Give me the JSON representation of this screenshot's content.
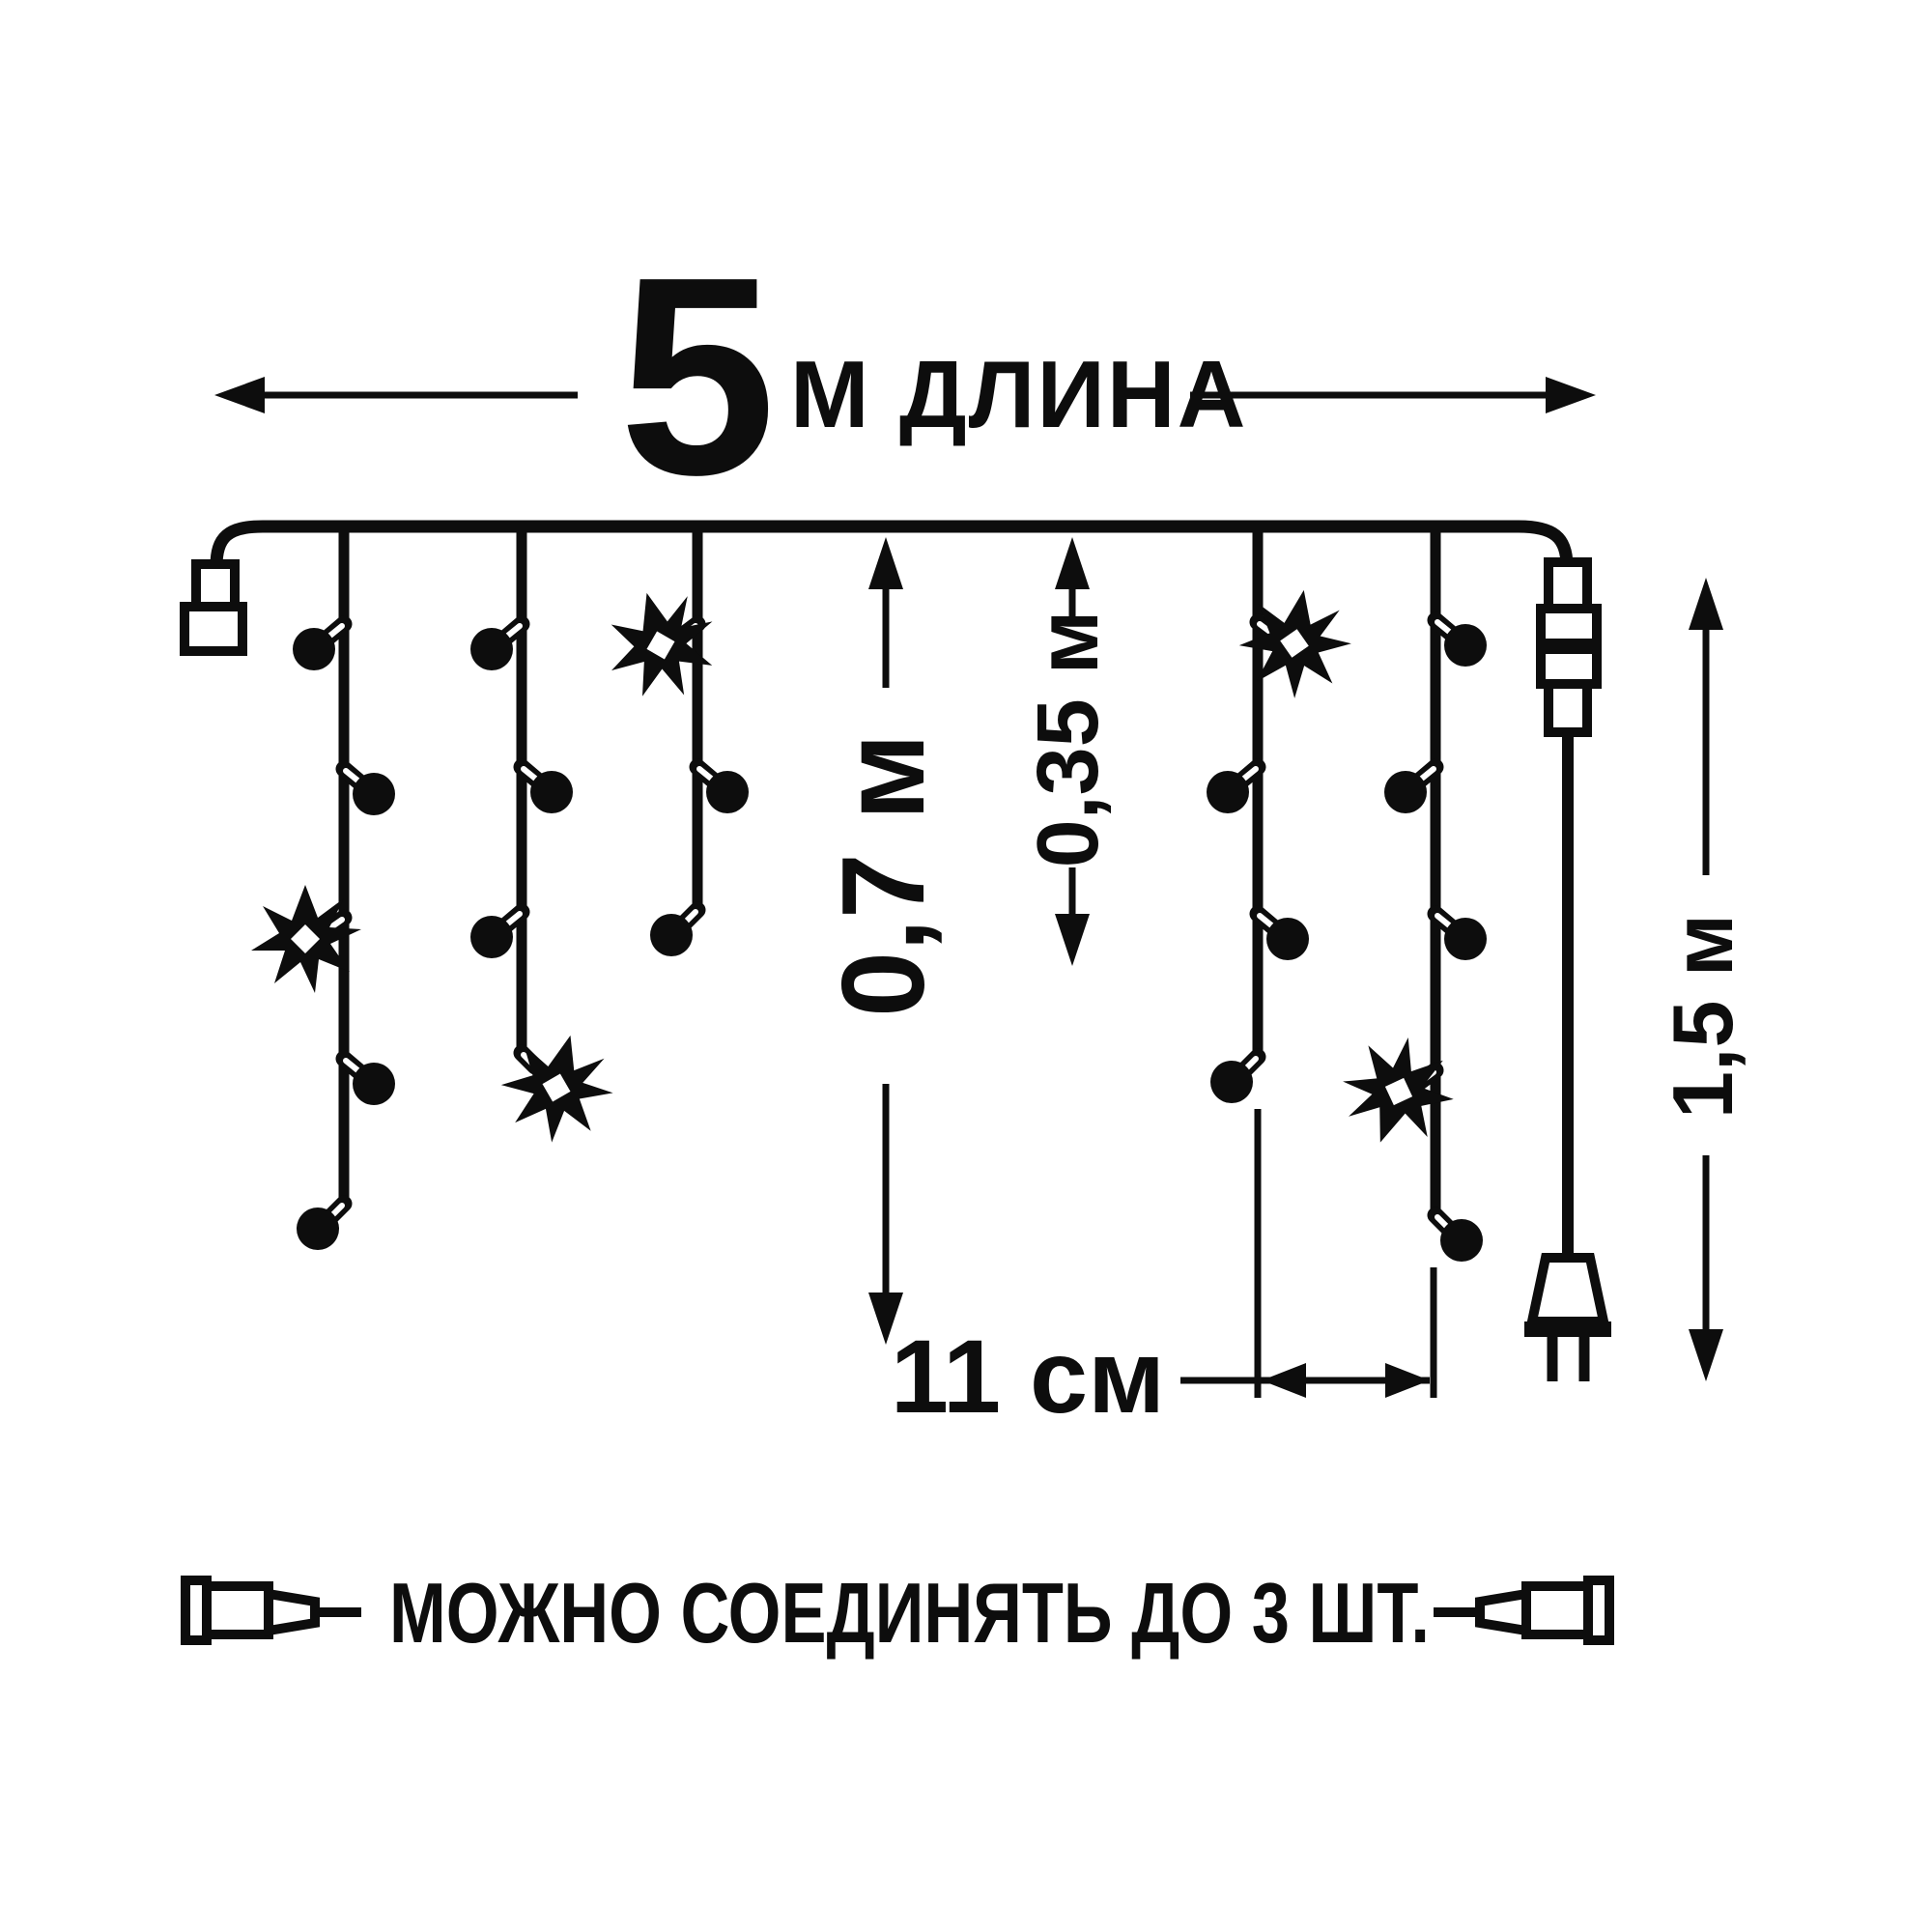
{
  "page": {
    "background": "#ffffff",
    "ink_color": "#0d0d0d"
  },
  "dimensions": {
    "total_length": {
      "value": "5",
      "unit_label": "м длина"
    },
    "drop_height_long": {
      "label": "0,7 м"
    },
    "drop_height_short": {
      "label": "0,35 м"
    },
    "power_lead_length": {
      "label": "1,5 м"
    },
    "bulb_spacing": {
      "label": "11 см"
    }
  },
  "caption": {
    "text": "МОЖНО СОЕДИНЯТЬ ДО 3 ШТ."
  },
  "garland": {
    "drop_count": 5,
    "drops": [
      {
        "index": 1,
        "lights": [
          "bulb",
          "bulb",
          "lit-bulb",
          "bulb",
          "bulb"
        ]
      },
      {
        "index": 2,
        "lights": [
          "bulb",
          "bulb",
          "bulb",
          "lit-bulb"
        ]
      },
      {
        "index": 3,
        "lights": [
          "lit-bulb",
          "bulb",
          "bulb"
        ]
      },
      {
        "index": 4,
        "lights": [
          "lit-bulb",
          "bulb",
          "bulb",
          "bulb"
        ]
      },
      {
        "index": 5,
        "lights": [
          "bulb",
          "bulb",
          "bulb",
          "lit-bulb",
          "bulb"
        ]
      }
    ]
  },
  "icons": {
    "end_connector": "end-connector-icon",
    "inline_connector": "inline-connector-icon",
    "power_plug": "power-plug-icon",
    "unlit_bulb": "bulb-icon",
    "lit_bulb": "star-bulb-icon",
    "caption_left": "male-connector-icon",
    "caption_right": "female-connector-icon",
    "dimension_arrow": "arrowhead-icon"
  }
}
